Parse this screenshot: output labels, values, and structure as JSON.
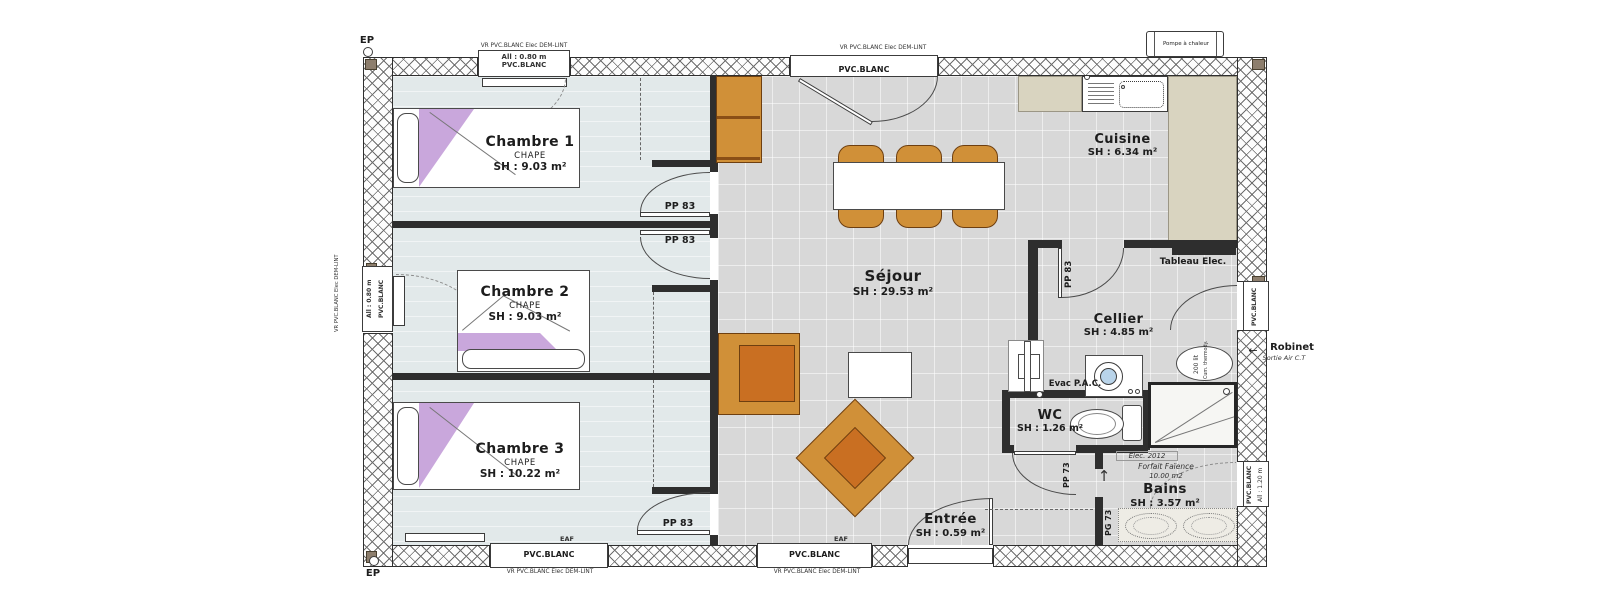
{
  "colors": {
    "furniture_orange": "#d09038",
    "furniture_orange_dark": "#c96f22",
    "bed_purple": "#c9a7dc",
    "counter_beige": "#d9d4c0",
    "bedroom_floor": "#e2e9ea",
    "tile_floor": "#d8d8d8",
    "wall": "#2e2e2e"
  },
  "rooms": {
    "chambre1": {
      "name": "Chambre 1",
      "screed": "CHAPE",
      "area": "SH : 9.03 m²"
    },
    "chambre2": {
      "name": "Chambre 2",
      "screed": "CHAPE",
      "area": "SH : 9.03 m²"
    },
    "chambre3": {
      "name": "Chambre 3",
      "screed": "CHAPE",
      "area": "SH : 10.22 m²"
    },
    "sejour": {
      "name": "Séjour",
      "area": "SH : 29.53 m²"
    },
    "cuisine": {
      "name": "Cuisine",
      "area": "SH : 6.34 m²"
    },
    "cellier": {
      "name": "Cellier",
      "area": "SH : 4.85 m²"
    },
    "wc": {
      "name": "WC",
      "area": "SH : 1.26 m²"
    },
    "bains": {
      "name": "Bains",
      "area": "SH : 3.57 m²",
      "elec_note": "Elec. 2012",
      "faience_note": "Forfait Faïence",
      "faience_area": "10.00 m2"
    },
    "entree": {
      "name": "Entrée",
      "area": "SH : 0.59 m²"
    }
  },
  "doors": {
    "pp83": "PP 83",
    "pp73": "PP 73",
    "pg73": "PG 73",
    "service_label": "PVC.BLANC"
  },
  "windows": {
    "ch1_top": {
      "alt": "All : 0.80 m",
      "material": "PVC.BLANC",
      "shutter": "VR PVC.BLANC Elec DEM-LINT"
    },
    "sejour_top": {
      "material": "PVC.BLANC",
      "shutter": "VR PVC.BLANC Elec DEM-LINT"
    },
    "ch2_left": {
      "alt": "All : 0.80 m",
      "material": "PVC.BLANC",
      "shutter": "VR PVC.BLANC Elec DEM-LINT"
    },
    "ch3_bottom": {
      "material": "PVC.BLANC",
      "tap": "EAF",
      "shutter": "VR PVC.BLANC Elec DEM-LINT"
    },
    "sejour_bottom": {
      "material": "PVC.BLANC",
      "tap": "EAF",
      "shutter": "VR PVC.BLANC Elec DEM-LINT"
    },
    "bains_right": {
      "material": "PVC.BLANC",
      "alt": "All : 1.20 m"
    }
  },
  "equipment": {
    "tableau": "Tableau Elec.",
    "evac": "Evac P.A.C.",
    "heater_capacity": "200 lit",
    "heater_type": "Cum. thermody.",
    "pompe": "Pompe à chaleur",
    "robinet": "Robinet",
    "sortie_air": "Sortie Air C.T",
    "ep": "EP"
  }
}
